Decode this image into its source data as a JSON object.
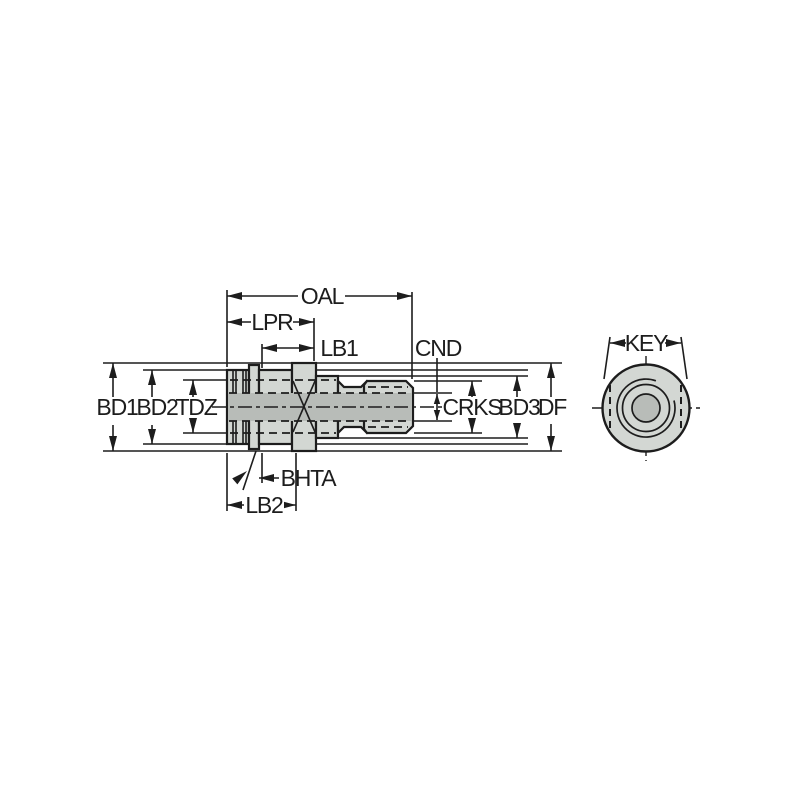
{
  "labels": {
    "oal": "OAL",
    "lpr": "LPR",
    "lb1": "LB1",
    "cnd": "CND",
    "bd1": "BD1",
    "bd2": "BD2",
    "tdz": "TDZ",
    "crks": "CRKS",
    "bd3": "BD3",
    "df": "DF",
    "bhta": "BHTA",
    "lb2": "LB2",
    "key": "KEY"
  },
  "colors": {
    "background": "#ffffff",
    "body_fill": "#d3d7d3",
    "bore_fill": "#b8bcb8",
    "line_color": "#1d1d1d"
  }
}
